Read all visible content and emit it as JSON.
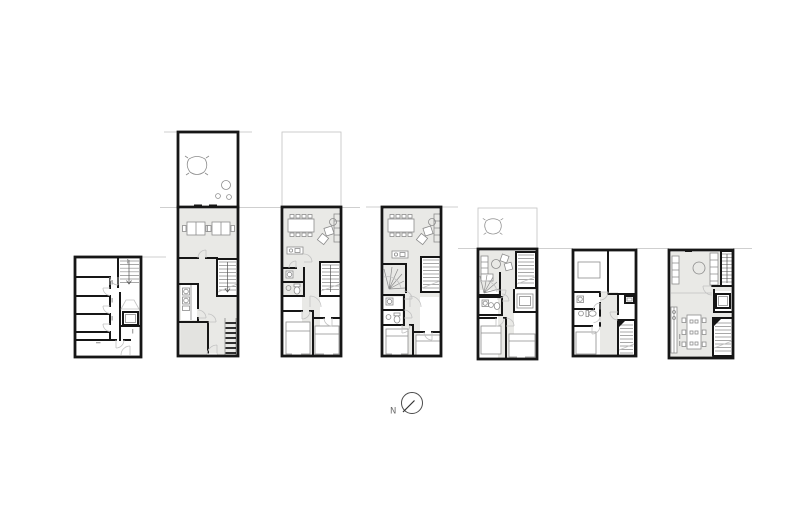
{
  "canvas": {
    "width": 800,
    "height": 532,
    "background": "#ffffff"
  },
  "colors": {
    "wall": "#161616",
    "furn": "#8c8c8c",
    "light": "#c2c2c2",
    "floor": "#e9e9e6",
    "floor2": "#e3e3e0",
    "sec": "#cfcfcf",
    "ink": "#6b6b6b"
  },
  "compass": {
    "north_label": "N"
  },
  "drawing": {
    "kind": "architectural-floor-plan-sheet",
    "plans": [
      {
        "id": "floor-plan-1",
        "type": "floor-plan"
      },
      {
        "id": "floor-plan-2",
        "type": "floor-plan-with-roof-terrace"
      },
      {
        "id": "floor-plan-3",
        "type": "floor-plan-with-terrace"
      },
      {
        "id": "floor-plan-4",
        "type": "floor-plan"
      },
      {
        "id": "floor-plan-5",
        "type": "floor-plan-with-terrace"
      },
      {
        "id": "floor-plan-6",
        "type": "floor-plan"
      },
      {
        "id": "floor-plan-7",
        "type": "floor-plan"
      }
    ]
  }
}
